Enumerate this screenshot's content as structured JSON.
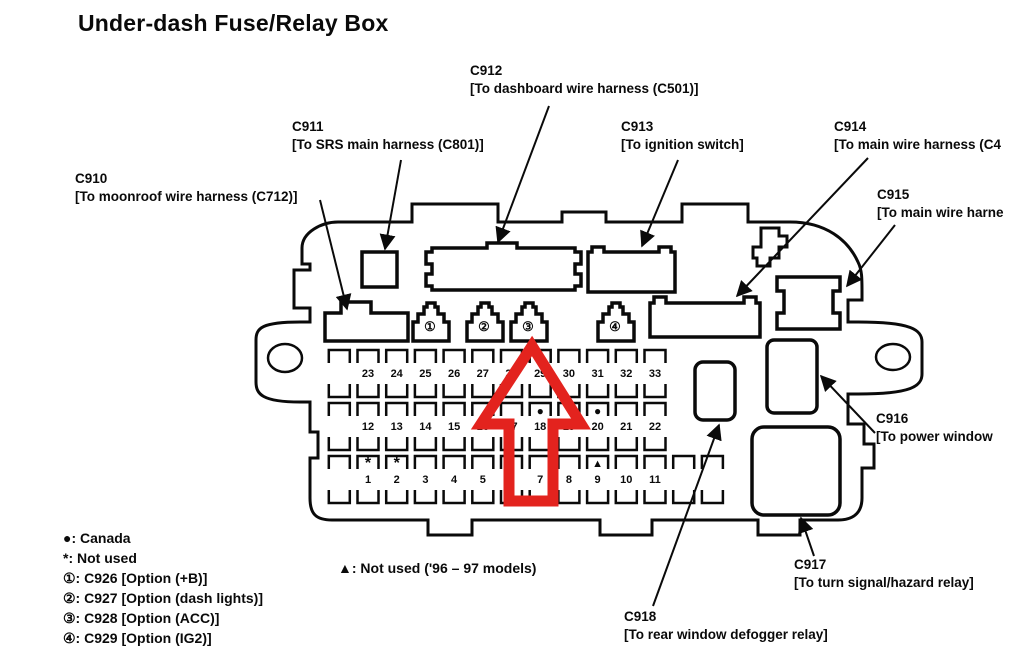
{
  "title": "Under-dash Fuse/Relay Box",
  "colors": {
    "diagram_line": "#0a0a0a",
    "highlight_arrow": "#e3231e"
  },
  "labels": {
    "c910": {
      "id": "C910",
      "desc": "[To moonroof wire harness (C712)]"
    },
    "c911": {
      "id": "C911",
      "desc": "[To SRS main harness (C801)]"
    },
    "c912": {
      "id": "C912",
      "desc": "[To dashboard wire harness (C501)]"
    },
    "c913": {
      "id": "C913",
      "desc": "[To ignition switch]"
    },
    "c914": {
      "id": "C914",
      "desc": "[To main wire harness (C4"
    },
    "c915": {
      "id": "C915",
      "desc": "[To main wire harne"
    },
    "c916": {
      "id": "C916",
      "desc": "[To power window"
    },
    "c917": {
      "id": "C917",
      "desc": "[To turn signal/hazard relay]"
    },
    "c918": {
      "id": "C918",
      "desc": "[To rear window defogger relay]"
    }
  },
  "numbered_connectors": [
    "①",
    "②",
    "③",
    "④"
  ],
  "fuse_grid": {
    "top_row": [
      "23",
      "24",
      "25",
      "26",
      "27",
      "28",
      "29",
      "30",
      "31",
      "32",
      "33"
    ],
    "middle_row": [
      "12",
      "13",
      "14",
      "15",
      "16",
      "17",
      "18",
      "19",
      "20",
      "21",
      "22"
    ],
    "bottom_row": [
      "1",
      "2",
      "3",
      "4",
      "5",
      "6",
      "7",
      "8",
      "9",
      "10",
      "11"
    ],
    "markers": [
      {
        "symbol": "●",
        "row": "middle",
        "fuse": "18"
      },
      {
        "symbol": "●",
        "row": "middle",
        "fuse": "20"
      },
      {
        "symbol": "*",
        "row": "bottom",
        "fuse": "1"
      },
      {
        "symbol": "*",
        "row": "bottom",
        "fuse": "2"
      },
      {
        "symbol": "▲",
        "row": "bottom",
        "fuse": "9"
      }
    ]
  },
  "legend": [
    "●: Canada",
    "*: Not used",
    "①: C926 [Option (+B)]",
    "②: C927 [Option (dash lights)]",
    "③: C928 [Option (ACC)]",
    "④: C929 [Option (IG2)]"
  ],
  "triangle_note": "▲: Not used ('96 – 97 models)"
}
